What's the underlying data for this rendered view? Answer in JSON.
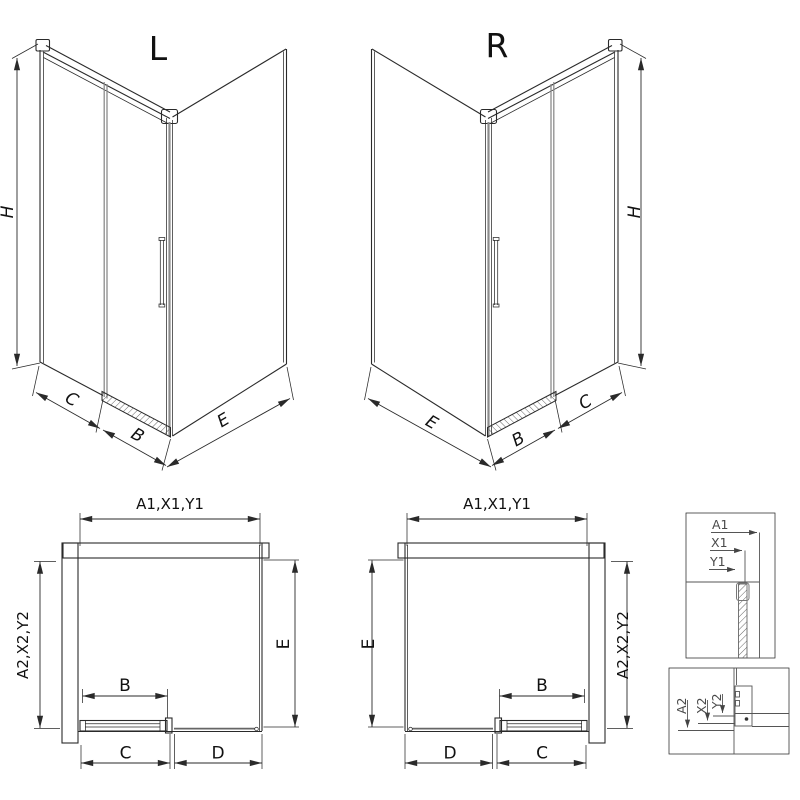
{
  "figures": {
    "iso_left": {
      "title": "L",
      "height_label": "H",
      "seg_c": "C",
      "seg_b": "B",
      "seg_e": "E"
    },
    "iso_right": {
      "title": "R",
      "height_label": "H",
      "seg_e": "E",
      "seg_b": "B",
      "seg_c": "C"
    },
    "plan_left": {
      "top": "A1,X1,Y1",
      "left": "A2,X2,Y2",
      "right": "E",
      "door": "B",
      "bottom_c": "C",
      "bottom_d": "D"
    },
    "plan_right": {
      "top": "A1,X1,Y1",
      "left": "E",
      "right": "A2,X2,Y2",
      "door": "B",
      "bottom_d": "D",
      "bottom_c": "C"
    },
    "detail_width": {
      "l1": "A1",
      "l2": "X1",
      "l3": "Y1"
    },
    "detail_depth": {
      "l1": "A2",
      "l2": "X2",
      "l3": "Y2"
    }
  },
  "colors": {
    "line": "#2a2a2a",
    "gray": "#8c8c8c",
    "background": "#ffffff"
  }
}
